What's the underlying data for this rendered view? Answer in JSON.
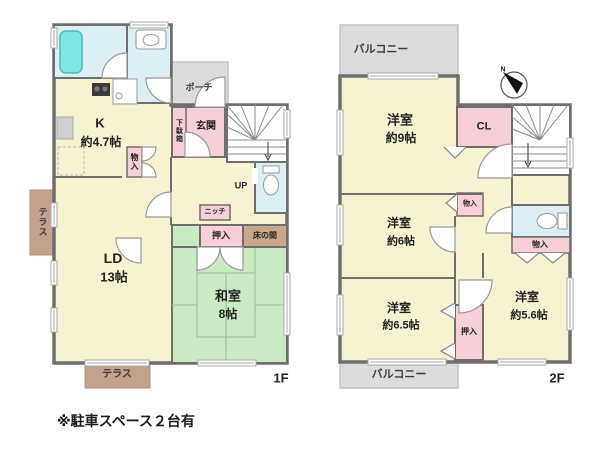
{
  "note": "※駐車スペース２台有",
  "floor1": {
    "tag": "1F",
    "kitchen": "K",
    "kitchen_size": "約4.7帖",
    "ld": "LD",
    "ld_size": "13帖",
    "washitsu": "和室",
    "washitsu_size": "8帖",
    "genkan": "玄関",
    "getabako": "下駄箱",
    "porch": "ポーチ",
    "monoiri": "物入",
    "niche": "ニッチ",
    "oshiire": "押入",
    "tokonoma": "床の間",
    "terrace_side": "テラス",
    "terrace_front": "テラス",
    "up": "UP"
  },
  "floor2": {
    "tag": "2F",
    "balcony_top": "バルコニー",
    "balcony_bottom": "バルコニー",
    "room9": "洋室",
    "room9_size": "約9帖",
    "room6": "洋室",
    "room6_size": "約6帖",
    "room65": "洋室",
    "room65_size": "約6.5帖",
    "room56": "洋室",
    "room56_size": "約5.6帖",
    "cl": "CL",
    "monoiri_a": "物入",
    "monoiri_b": "物入",
    "oshiire": "押入",
    "compass_north": "N"
  },
  "colors": {
    "wall": "#6E6E6E",
    "room_floor": "#F6F2D2",
    "tatami": "#CBE9C4",
    "tatami_line": "#9CC79B",
    "water_area": "#DCEFF5",
    "bathtub": "#7FE6E2",
    "closet_pink": "#F7CFD7",
    "tokonoma_tan": "#C8A98B",
    "terrace_brown": "#C2A18F",
    "balcony_gray": "#DCDCDC"
  }
}
